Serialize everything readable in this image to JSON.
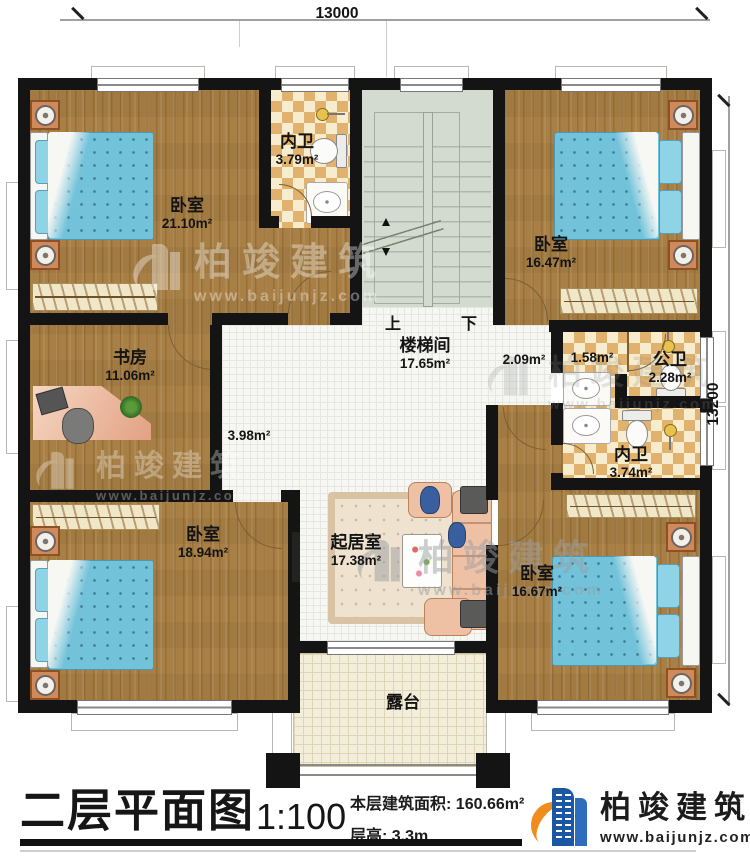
{
  "title_block": {
    "plan_title": "二层平面图",
    "scale": "1:100",
    "area_label": "本层建筑面积:",
    "area_value": "160.66m²",
    "height_label": "层高:",
    "height_value": "3.3m"
  },
  "brand": {
    "name": "柏竣建筑",
    "url": "www.baijunjz.com"
  },
  "watermark": {
    "name": "柏竣建筑",
    "url": "www.baijunjz.com"
  },
  "dimensions": {
    "top": "13000",
    "right": "13200"
  },
  "rooms": {
    "bedroom_tl": {
      "name": "卧室",
      "area": "21.10m²"
    },
    "bath_tl": {
      "name": "内卫",
      "area": "3.79m²"
    },
    "stair": {
      "name": "楼梯间",
      "area": "17.65m²",
      "up": "上",
      "down": "下"
    },
    "bedroom_tr": {
      "name": "卧室",
      "area": "16.47m²"
    },
    "study": {
      "name": "书房",
      "area": "11.06m²"
    },
    "hall": {
      "area": "3.98m²"
    },
    "corridor": {
      "area": "2.09m²"
    },
    "vanity": {
      "area": "1.58m²"
    },
    "bath_public": {
      "name": "公卫",
      "area": "2.28m²"
    },
    "bath_br": {
      "name": "内卫",
      "area": "3.74m²"
    },
    "bedroom_bl": {
      "name": "卧室",
      "area": "18.94m²"
    },
    "living": {
      "name": "起居室",
      "area": "17.38m²"
    },
    "bedroom_br": {
      "name": "卧室",
      "area": "16.67m²"
    },
    "terrace": {
      "name": "露台"
    }
  },
  "colors": {
    "wall": "#141414",
    "wood_floor": "#a87f45",
    "checker_tile": "#e0b26d",
    "stair_floor": "#d3dbd0",
    "bed_quilt": "#72c2da",
    "brand_blue": "#1c57a5",
    "brand_orange": "#ef8c1c"
  }
}
